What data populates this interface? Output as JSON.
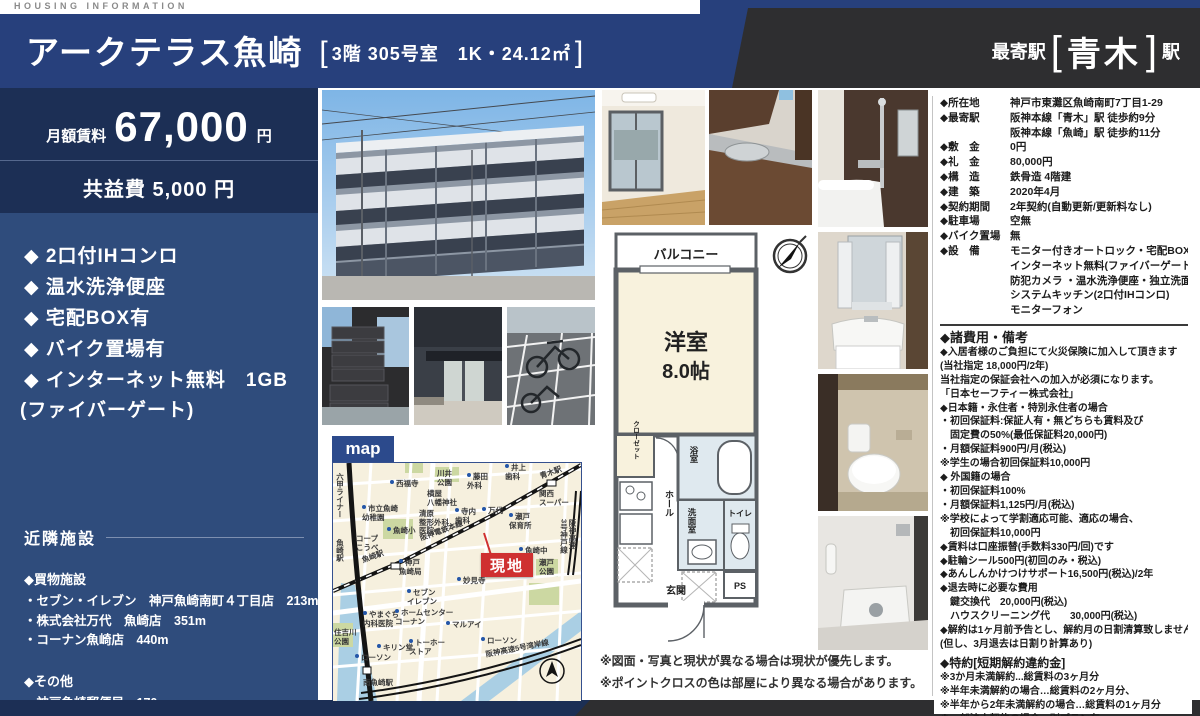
{
  "eyebrow": "HOUSING INFORMATION",
  "header": {
    "title": "アークテラス魚崎",
    "bracket_open": "[",
    "bracket_close": "]",
    "unit_info": "3階 305号室　1K・24.12㎡",
    "station_label": "最寄駅",
    "station_name": "青木",
    "station_unit": "駅"
  },
  "pricing": {
    "rent_label": "月額賃料",
    "rent_value": "67,000",
    "rent_unit": "円",
    "common_fee": "共益費 5,000 円"
  },
  "features": [
    "◆ 2口付IHコンロ",
    "◆ 温水洗浄便座",
    "◆ 宅配BOX有",
    "◆ バイク置場有",
    "◆ インターネット無料　1GB"
  ],
  "features_sub": "(ファイバーゲート)",
  "neighborhood": {
    "title": "近隣施設",
    "shopping_title": "◆買物施設",
    "shops": [
      "・セブン・イレブン　神戸魚崎南町４丁目店　213m",
      "・株式会社万代　魚崎店　351m",
      "・コーナン魚崎店　440m"
    ],
    "other_title": "◆その他",
    "others": [
      "・神戸魚崎郵便局　170m"
    ]
  },
  "map": {
    "tag": "map",
    "site_label": "現地",
    "compass_n": "N",
    "labels": [
      {
        "text": "六甲ライナー",
        "x": 2,
        "y": 10,
        "cls": "v"
      },
      {
        "text": "西福寺",
        "x": 57,
        "y": 17,
        "cls": "dot"
      },
      {
        "text": "川井\n公園",
        "x": 104,
        "y": 7
      },
      {
        "text": "藤田\n外科",
        "x": 134,
        "y": 10,
        "cls": "dot"
      },
      {
        "text": "井上\n歯科",
        "x": 172,
        "y": 1,
        "cls": "dot"
      },
      {
        "text": "青木駅",
        "x": 206,
        "y": 10,
        "cls": "r1"
      },
      {
        "text": "関西\nスーパー",
        "x": 206,
        "y": 27
      },
      {
        "text": "横屋\n八幡神社",
        "x": 94,
        "y": 27
      },
      {
        "text": "市立魚崎\n幼稚園",
        "x": 29,
        "y": 42,
        "cls": "dot"
      },
      {
        "text": "清原\n整形外科\n医院",
        "x": 86,
        "y": 47
      },
      {
        "text": "寺内\n歯科",
        "x": 122,
        "y": 45,
        "cls": "dot"
      },
      {
        "text": "万代",
        "x": 149,
        "y": 44,
        "cls": "dot"
      },
      {
        "text": "瀬戸\n保育所",
        "x": 176,
        "y": 50,
        "cls": "dot"
      },
      {
        "text": "魚崎小",
        "x": 54,
        "y": 64,
        "cls": "dot"
      },
      {
        "text": "コープ\nこうべ",
        "x": 23,
        "y": 72
      },
      {
        "text": "阪神電鉄本線",
        "x": 86,
        "y": 72,
        "cls": "r1"
      },
      {
        "text": "魚崎駅",
        "x": 2,
        "y": 76,
        "cls": "v"
      },
      {
        "text": "魚崎駅",
        "x": 28,
        "y": 94,
        "cls": "r1"
      },
      {
        "text": "神戸\n魚崎局",
        "x": 66,
        "y": 96,
        "cls": "dot"
      },
      {
        "text": "魚崎中",
        "x": 186,
        "y": 84,
        "cls": "dot"
      },
      {
        "text": "瀬戸\n公園",
        "x": 206,
        "y": 96
      },
      {
        "text": "阪神高速\n3号神戸線",
        "x": 226,
        "y": 56,
        "cls": "v"
      },
      {
        "text": "妙見寺",
        "x": 124,
        "y": 114,
        "cls": "dot"
      },
      {
        "text": "セブン\nイレブン",
        "x": 74,
        "y": 126,
        "cls": "dot"
      },
      {
        "text": "やまぐち\n内科医院",
        "x": 30,
        "y": 148,
        "cls": "dot"
      },
      {
        "text": "ホームセンター\nコーナン",
        "x": 62,
        "y": 146,
        "cls": "dot"
      },
      {
        "text": "マルアイ",
        "x": 113,
        "y": 158,
        "cls": "dot"
      },
      {
        "text": "住吉川\n公園",
        "x": 1,
        "y": 166
      },
      {
        "text": "キリン堂",
        "x": 44,
        "y": 181,
        "cls": "dot"
      },
      {
        "text": "トーホー\nストア",
        "x": 76,
        "y": 176,
        "cls": "dot"
      },
      {
        "text": "ローソン",
        "x": 22,
        "y": 191,
        "cls": "dot"
      },
      {
        "text": "ローソン",
        "x": 148,
        "y": 174,
        "cls": "dot"
      },
      {
        "text": "南魚崎駅",
        "x": 30,
        "y": 216
      },
      {
        "text": "阪神高速5号湾岸線",
        "x": 152,
        "y": 188,
        "cls": "r2"
      }
    ]
  },
  "plan": {
    "balcony": "バルコニー",
    "room": "洋室",
    "size": "8.0帖",
    "closet": "クローゼット",
    "bath": "浴室",
    "wash": "洗面室",
    "toilet": "トイレ",
    "hall": "ホール",
    "entrance": "玄関",
    "ps": "PS",
    "notes": [
      "※図面・写真と現状が異なる場合は現状が優先します。",
      "※ポイントクロスの色は部屋により異なる場合があります。"
    ]
  },
  "details": {
    "rows": [
      {
        "label": "◆所在地",
        "value": "神戸市東灘区魚崎南町7丁目1-29"
      },
      {
        "label": "◆最寄駅",
        "value": "阪神本線「青木」駅 徒歩約9分"
      },
      {
        "label": "",
        "value": "阪神本線「魚崎」駅 徒歩約11分"
      },
      {
        "label": "◆敷　金",
        "value": "0円"
      },
      {
        "label": "◆礼　金",
        "value": "80,000円"
      },
      {
        "label": "◆構　造",
        "value": "鉄骨造 4階建"
      },
      {
        "label": "◆建　築",
        "value": "2020年4月"
      },
      {
        "label": "◆契約期間",
        "value": "2年契約(自動更新/更新料なし)"
      },
      {
        "label": "◆駐車場",
        "value": "空無"
      },
      {
        "label": "◆バイク置場",
        "value": "無"
      },
      {
        "label": "◆設　備",
        "value": "モニター付きオートロック・宅配BOX"
      },
      {
        "label": "",
        "value": "インターネット無料(ファイバーゲート)"
      },
      {
        "label": "",
        "value": "防犯カメラ ・温水洗浄便座・独立洗面台"
      },
      {
        "label": "",
        "value": "システムキッチン(2口付IHコンロ)"
      },
      {
        "label": "",
        "value": "モニターフォン"
      }
    ],
    "fees_title": "◆諸費用・備考",
    "fees": [
      "◆入居者様のご負担にて火災保険に加入して頂きます",
      "(当社指定 18,000円/2年)",
      "当社指定の保証会社への加入が必須になります。",
      "「日本セーフティー株式会社」",
      "◆日本籍・永住者・特別永住者の場合",
      "・初回保証料:保証人有・無どちらも賃料及び",
      "　固定費の50%(最低保証料20,000円)",
      "・月額保証料900円/月(税込)",
      "※学生の場合初回保証料10,000円",
      "◆ 外国籍の場合",
      "・初回保証料100%",
      "・月額保証料1,125円/月(税込)",
      "※学校によって学割適応可能、適応の場合、",
      "　初回保証料10,000円",
      "◆賃料は口座振替(手数料330円/回)です",
      "◆駐輪シール500円(初回のみ・税込)",
      "◆あんしんかけつけサポート16,500円(税込)/2年",
      "◆退去時に必要な費用",
      "　鍵交換代　20,000円(税込)",
      "　ハウスクリーニング代　　30,000円(税込)",
      "◆解約は1ヶ月前予告とし、解約月の日割清算致しません",
      "(但し、3月退去は日割り計算あり)"
    ],
    "special_title": "◆特約[短期解約違約金]",
    "special": [
      "※3か月未満解約...総賃料の3ヶ月分",
      "※半年未満解約の場合…総賃料の2ヶ月分、",
      "※半年から2年未満解約の場合…総賃料の1ヶ月分",
      "※一部法人契約の場合、別プラン有"
    ]
  },
  "colors": {
    "navy": "#27407c",
    "dark_navy": "#1c2f55",
    "panel_blue": "#2f4c7c",
    "charcoal": "#2e2e30",
    "site_red": "#cf3030"
  }
}
